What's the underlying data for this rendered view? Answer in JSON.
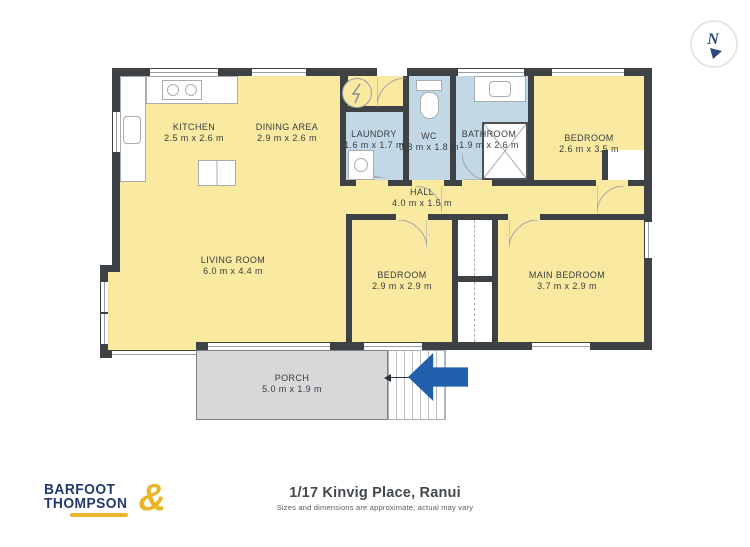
{
  "meta": {
    "address": "1/17 Kinvig Place, Ranui",
    "disclaimer": "Sizes and dimensions are approximate, actual may vary"
  },
  "branding": {
    "logo_line1": "BARFOOT",
    "logo_line2": "THOMPSON",
    "logo_ampersand": "&"
  },
  "compass": {
    "label": "N"
  },
  "rooms": [
    {
      "id": "kitchen",
      "name": "KITCHEN",
      "dims": "2.5 m x 2.6 m"
    },
    {
      "id": "dining",
      "name": "DINING AREA",
      "dims": "2.9 m x 2.6 m"
    },
    {
      "id": "laundry",
      "name": "LAUNDRY",
      "dims": "1.6 m x 1.7 m"
    },
    {
      "id": "wc",
      "name": "WC",
      "dims": "0.8 m x 1.8 m"
    },
    {
      "id": "bathroom",
      "name": "BATHROOM",
      "dims": "1.9 m x 2.6 m"
    },
    {
      "id": "bedroom-top",
      "name": "BEDROOM",
      "dims": "2.6 m x 3.5 m"
    },
    {
      "id": "hall",
      "name": "HALL",
      "dims": "4.0 m x 1.5 m"
    },
    {
      "id": "living",
      "name": "LIVING ROOM",
      "dims": "6.0 m x 4.4 m"
    },
    {
      "id": "bedroom-mid",
      "name": "BEDROOM",
      "dims": "2.9 m x 2.9 m"
    },
    {
      "id": "main-bedroom",
      "name": "MAIN BEDROOM",
      "dims": "3.7 m x 2.9 m"
    },
    {
      "id": "porch",
      "name": "PORCH",
      "dims": "5.0 m x 1.9 m"
    }
  ],
  "palette": {
    "floor_yellow": "#f9e9a1",
    "wet_room_blue": "#c3d8e6",
    "wall_dark": "#3f4245",
    "porch_grey": "#d6d8da",
    "arrow_blue": "#2160ac",
    "logo_navy": "#223a70",
    "logo_gold": "#eab529"
  }
}
